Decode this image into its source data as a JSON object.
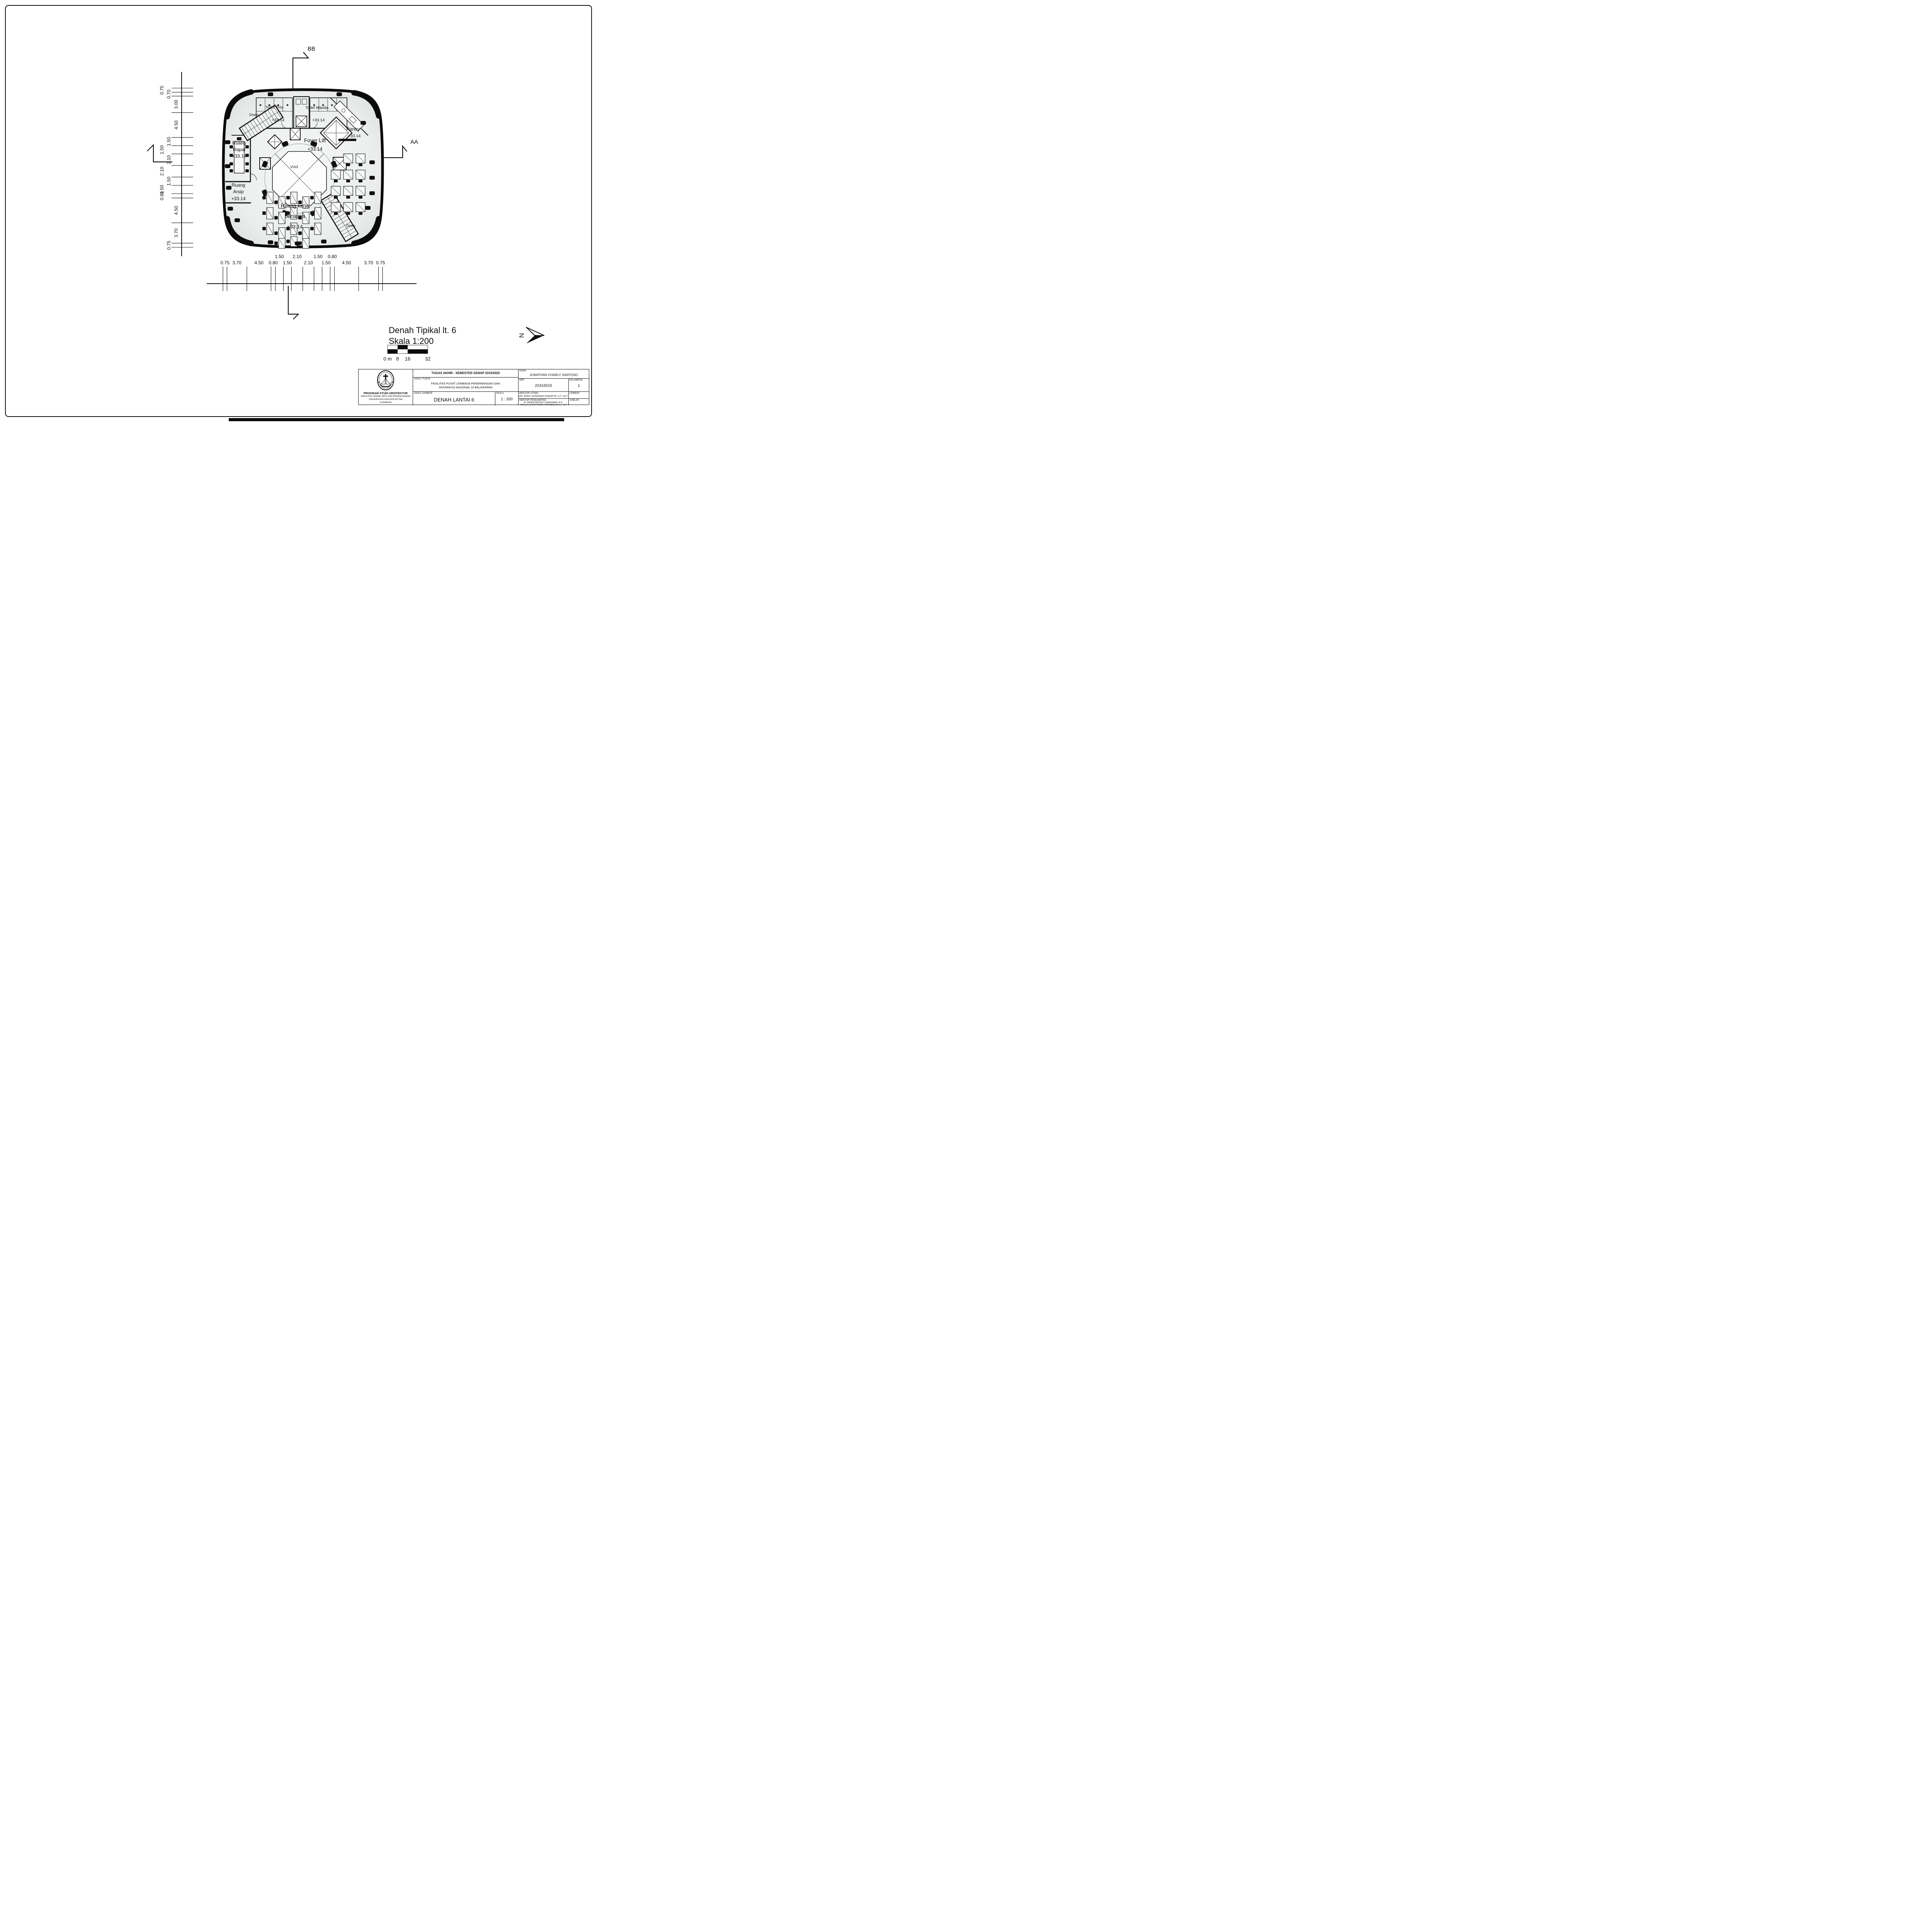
{
  "colors": {
    "ink": "#0f0f0f",
    "floor_light": "#f4f5f5",
    "floor_dark": "#dfe3e2"
  },
  "plan": {
    "labels": {
      "toilet_pria": "Toilet Pria",
      "toilet_pria_elev": "+33.14",
      "toilet_wanita": "Toilet Wanita",
      "toilet_wanita_elev": "+33.14",
      "foyer_lift": "Foyer Lift",
      "foyer_lift_elev": "+33.14",
      "pantry": "Pantry",
      "pantry_elev": "+33.14",
      "ruang_rapat_1": "Ruang",
      "ruang_rapat_2": "Rapat",
      "ruang_rapat_elev": "+33.14",
      "ruang_arsip_1": "Ruang",
      "ruang_arsip_2": "Arsip",
      "ruang_arsip_elev": "+33.14",
      "ruang_kerja_1": "Ruang kerja",
      "ruang_kerja_2": "bersama",
      "ruang_kerja_elev": "+33.14",
      "void": "Void",
      "down_nw": "Down",
      "down_se": "Down",
      "section_top": "BB",
      "section_right": "AA"
    }
  },
  "dimensions": {
    "left": [
      "0.75",
      "0.70",
      "3.00",
      "4.50",
      "1.50",
      "1.50",
      "2.10",
      "2.10",
      "1.50",
      "1.50",
      "0.80",
      "4.50",
      "3.70",
      "0.75"
    ],
    "bottom": [
      "0.75",
      "3.70",
      "4.50",
      "0.80",
      "1.50",
      "1.50",
      "2.10",
      "2.10",
      "1.50",
      "1.50",
      "0.80",
      "4.50",
      "3.70",
      "0.75"
    ]
  },
  "footer": {
    "title": "Denah Tipikal lt. 6",
    "scale": "Skala 1:200",
    "scalebar_labels": [
      "0 m",
      "8",
      "16",
      "32"
    ],
    "north": "N"
  },
  "titleblock": {
    "header": "TUGAS AKHIR - SEMESTER GENAP 2019/2020",
    "judul_tugas_label": "JUDUL TUGAS",
    "judul_tugas_1": "FASILITAS PUSAT LEMBAGA PENERBANGAN DAN",
    "judul_tugas_2": "ANTARIKSA NASIONAL DI BALIKPAPAN",
    "judul_gambar_label": "JUDUL GAMBAR",
    "judul_gambar": "DENAH LANTAI 6",
    "skala_label": "SKALA",
    "skala": "1 : 200",
    "nama_label": "NAMA",
    "nama": "JONATHAN CHARLY SANTOSO",
    "nrp_label": "NRP",
    "nrp": "22416015",
    "kelompok_label": "KELOMPOK",
    "kelompok": "1",
    "mentor_utama_label": "MENTOR UTAMA",
    "mentor_utama": "DR. RONY GUNAWAN SUNARYO, S.T., M.T.",
    "mentor_pendamping_label": "MENTOR PENDAMPING",
    "mentor_pendamping_1": "IR. WANDA WIDIGDO CANADARMA, M.SI.",
    "mentor_pendamping_2": "ANGELA CHRISTYSONIA TAMPUBOLON S.T., M.T.",
    "lembar_label": "LEMBAR",
    "jumlah_label": "JUMLAH",
    "program_1": "PROGRAM STUDI ARSITEKTUR",
    "program_2": "FAKULTAS TEKNIK SIPIL DAN PERENCANAAN",
    "program_3": "UNIVERSITAS KRISTEN PETRA",
    "program_4": "SURABAYA"
  }
}
